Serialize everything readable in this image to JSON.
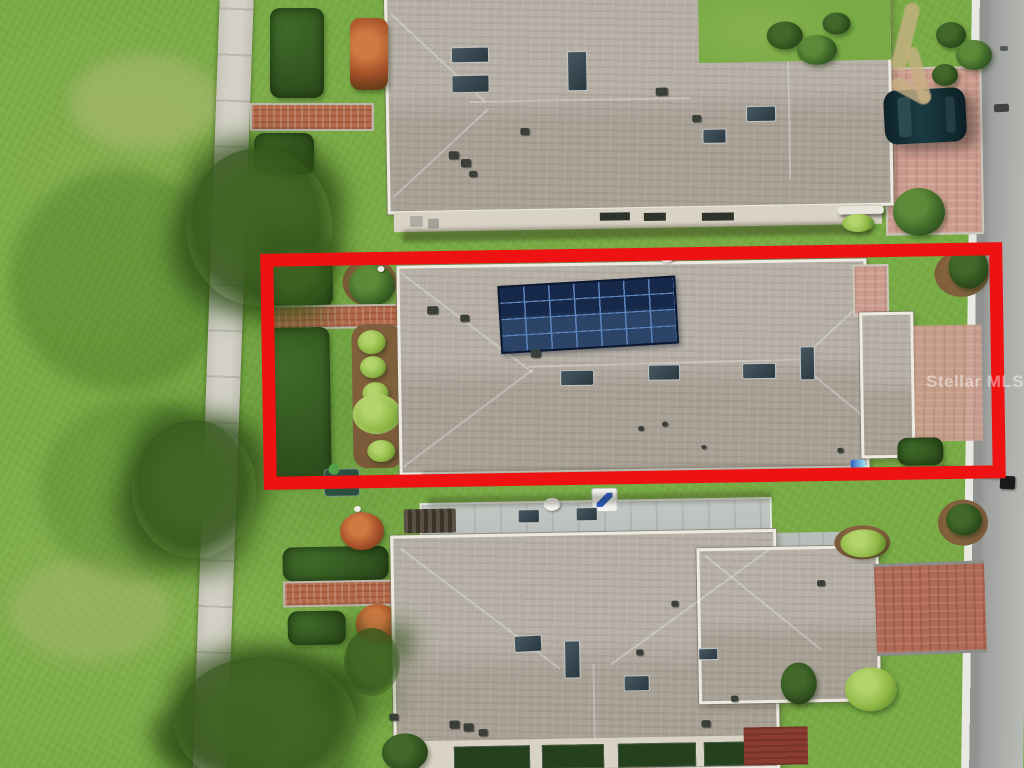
{
  "scene": {
    "type": "aerial-drone-photo",
    "description": "Overhead aerial photo of a residential street; the middle single-story home with a rooftop solar array is outlined by a red highlight rectangle.",
    "watermark": {
      "text": "Stellar MLS"
    },
    "solar_array": {
      "rows": 4,
      "columns": 7,
      "panel_color": "#16294a",
      "grid_color": "#5d84ba"
    },
    "objects": {
      "highlight_box": "red rectangle outlining the subject property",
      "subject_house": "gray shingle hip roof with 28-panel solar array, skylights and roof vents",
      "north_house": "neighboring house at top with skylights, brick driveway and parked SUV",
      "south_house": "neighboring house at bottom with metal roof section, satellite dish and brick driveway",
      "car": "dark green SUV parked on brick paver driveway",
      "road": "light gray asphalt street with white curb along right edge",
      "sidewalk": "concrete sidewalk running vertically at left",
      "walkways": "red brick paver walkways from sidewalk to each front door",
      "mailbox": "dark mailbox at curb near bottom-right of highlight box",
      "trees": "three scraggly trees along the sidewalk and shrubs/hedges in garden beds",
      "lawn": "large open green lawn on the left"
    },
    "colors": {
      "grass": "#79ab45",
      "roof": "#b2aa9f",
      "fascia": "#edebe1",
      "metal": "#b9bebb",
      "solar": "#16294a",
      "solargrid": "#5d84ba",
      "walk-brick": "#b26a4b",
      "drive-pink": "#cb9c8e",
      "drive-red": "#b06a55",
      "road": "#a2a4a1",
      "curb": "#e9e9e3",
      "red": "#ee1212",
      "hedge": "#2f5420",
      "bushy": "#8fb846",
      "mulch": "#7a5a39",
      "car": "#13292f",
      "wall": "#d9d3c5",
      "concrete": "#d3d1c6",
      "dark-steel": "#37474f"
    }
  }
}
